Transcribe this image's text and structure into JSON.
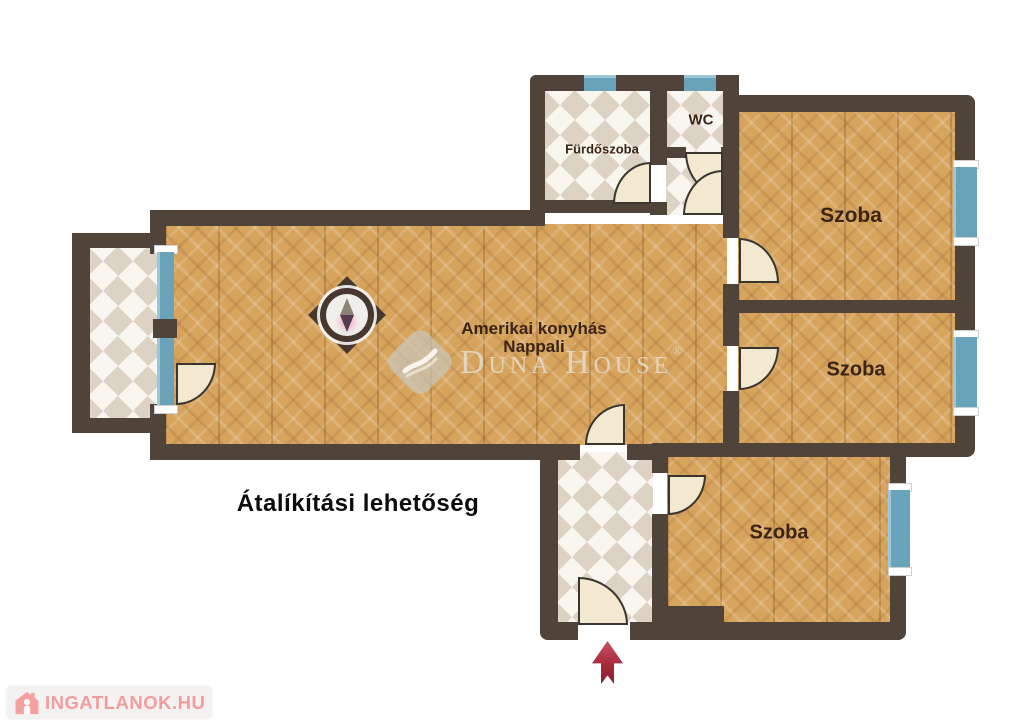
{
  "plan": {
    "rooms": {
      "living": {
        "label_line1": "Amerikai konyhás",
        "label_line2": "Nappali"
      },
      "bathroom": {
        "label": "Fürdőszoba"
      },
      "wc": {
        "label": "WC"
      },
      "room_top": {
        "label": "Szoba"
      },
      "room_middle": {
        "label": "Szoba"
      },
      "room_bottom": {
        "label": "Szoba"
      }
    },
    "annotation": "Átalíkítási lehetőség",
    "entrance_arrow": {
      "direction": "up",
      "color": "#a42738"
    }
  },
  "watermarks": {
    "duna_house": {
      "name": "Duna House",
      "registered": "®"
    },
    "ingatlanok": {
      "label": "INGATLANOK.HU"
    }
  },
  "colors": {
    "wall": "#50433a",
    "wood_floor": "#d7a45e",
    "tile_accent": "#ddd3c5",
    "window_blue": "#68a3ba",
    "door_fill": "#f3e8d0",
    "label_brown": "#3b2415",
    "watermark_pink": "#f29494",
    "duna_beige": "#e2d9c4"
  }
}
